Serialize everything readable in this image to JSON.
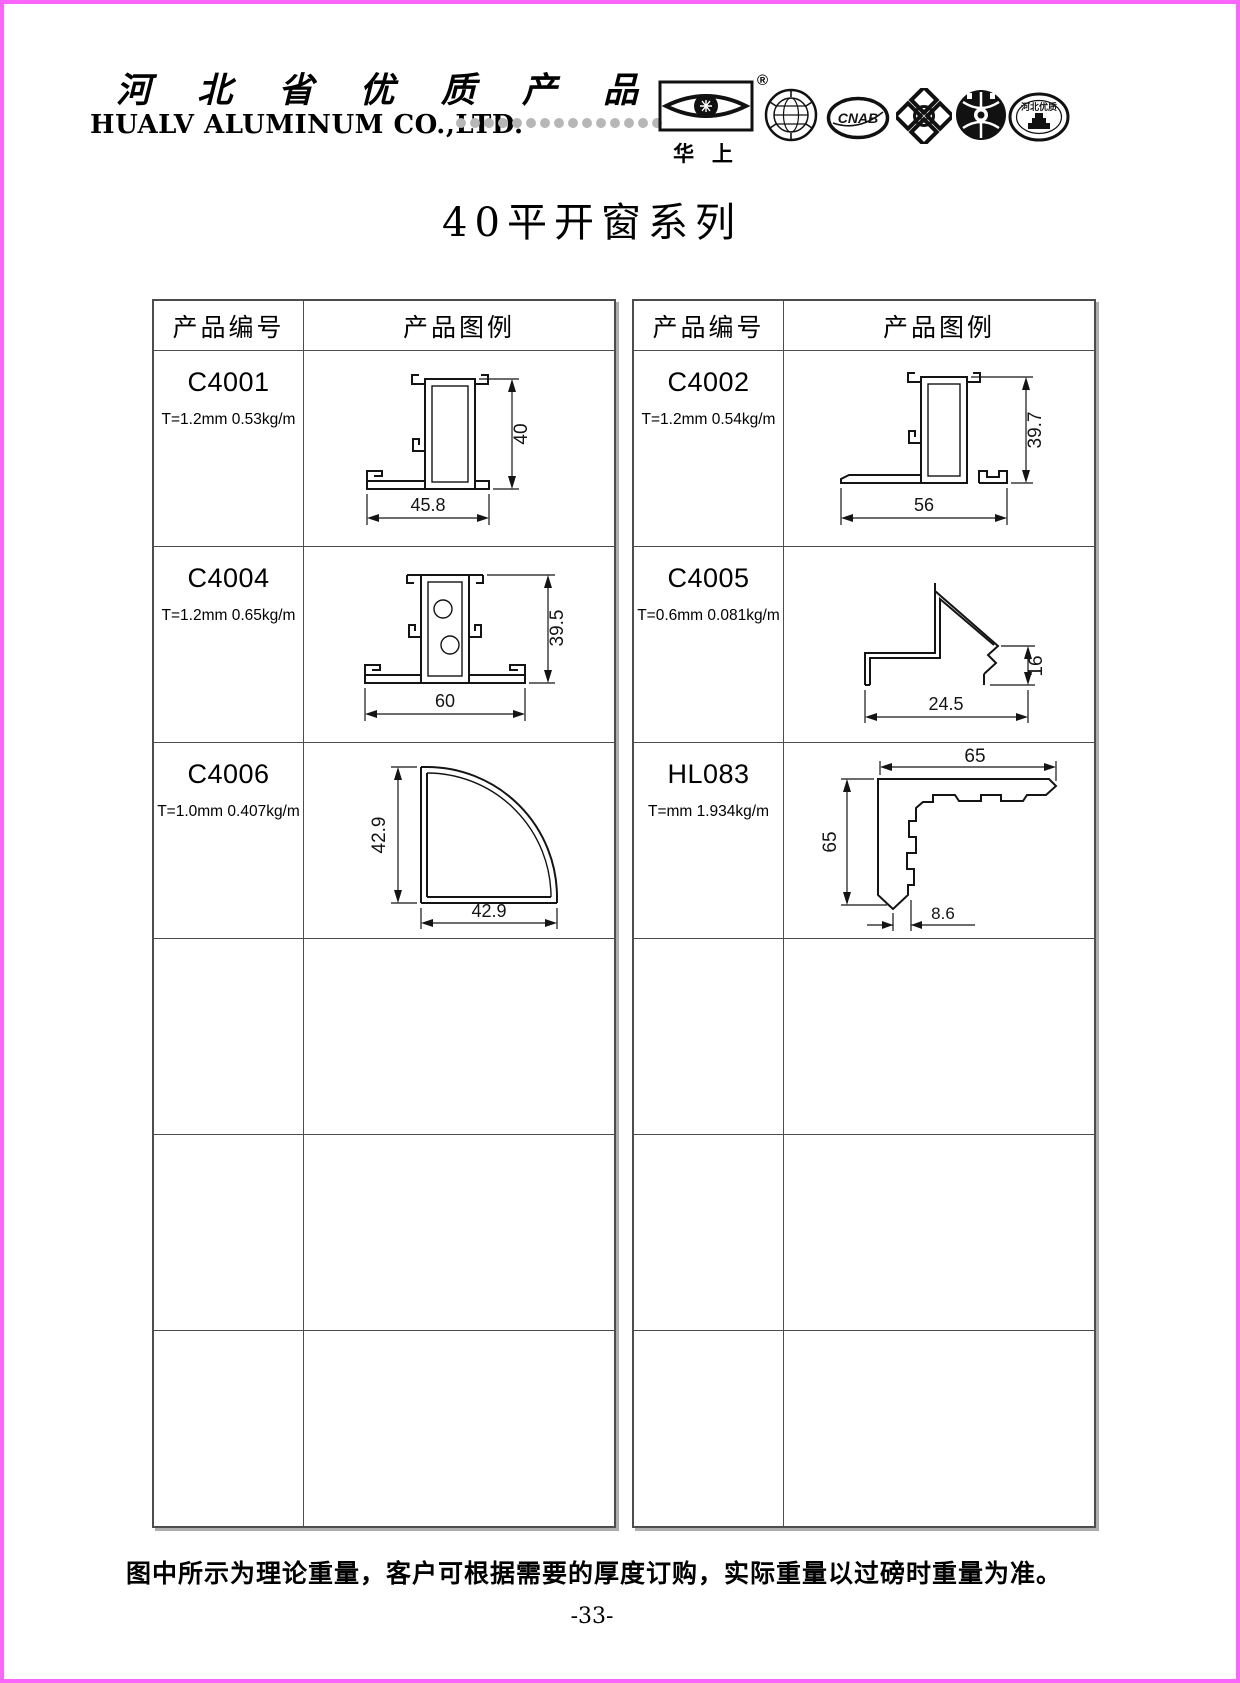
{
  "page_border_color": "#f966f9",
  "header": {
    "cn_title": "河 北 省 优 质 产 品",
    "en_title": "HUALV ALUMINUM CO.,LTD.",
    "dots_count": 15,
    "brand": {
      "name": "华 上",
      "reg": "®"
    },
    "badges": {
      "cnab": "CNAB",
      "q": "Q",
      "hebei": "河北优质"
    },
    "badge_icons": [
      "hua-shang-eye-logo",
      "globe-seal",
      "cnab-oval",
      "quatrefoil-q",
      "globe-hands-round",
      "hebei-quality-oval"
    ]
  },
  "title": "40平开窗系列",
  "table_headers": {
    "code": "产品编号",
    "figure": "产品图例"
  },
  "products": {
    "left": [
      {
        "code": "C4001",
        "spec": "T=1.2mm 0.53kg/m",
        "width": "45.8",
        "height": "40"
      },
      {
        "code": "C4004",
        "spec": "T=1.2mm 0.65kg/m",
        "width": "60",
        "height": "39.5"
      },
      {
        "code": "C4006",
        "spec": "T=1.0mm 0.407kg/m",
        "width": "42.9",
        "height": "42.9"
      }
    ],
    "right": [
      {
        "code": "C4002",
        "spec": "T=1.2mm 0.54kg/m",
        "width": "56",
        "height": "39.7"
      },
      {
        "code": "C4005",
        "spec": "T=0.6mm 0.081kg/m",
        "width": "24.5",
        "height": "16"
      },
      {
        "code": "HL083",
        "spec": "T=mm 1.934kg/m",
        "width": "65",
        "height": "65",
        "thickness": "8.6"
      }
    ]
  },
  "footer": {
    "note": "图中所示为理论重量，客户可根据需要的厚度订购，实际重量以过磅时重量为准。",
    "page_number": "-33-"
  }
}
